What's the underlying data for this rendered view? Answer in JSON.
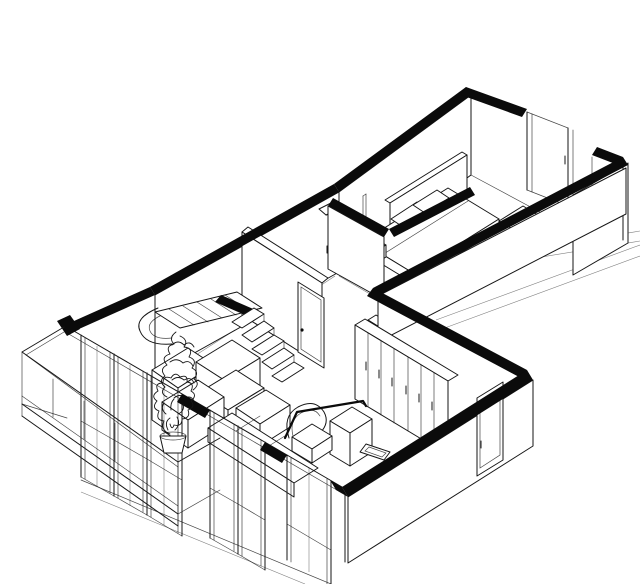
{
  "figure": {
    "kind": "isometric-cutaway-floor-plan",
    "description": "Black-and-white axonometric architectural drawing of an apartment, walls cut at mid height shown as solid black bands",
    "aria_label": "Isometric cutaway floor plan of an apartment"
  },
  "colors": {
    "background": "#ffffff",
    "line": "#161616",
    "cut_wall": "#0b0b0b"
  },
  "rooms": [
    {
      "name": "bedroom",
      "aria_label": "Bedroom with bed, headboard and sliding glass door"
    },
    {
      "name": "bathroom",
      "aria_label": "Bathroom with shower, glass screen and door"
    },
    {
      "name": "hallway",
      "aria_label": "Hallway with wardrobe cabinet"
    },
    {
      "name": "living-room",
      "aria_label": "Living room with stair seating boxes, sofa and armchair"
    },
    {
      "name": "kitchen",
      "aria_label": "Kitchen corner with counter, cabinet and arc lamp"
    },
    {
      "name": "balcony",
      "aria_label": "Balcony with glass railing and potted plant"
    }
  ],
  "furniture": [
    {
      "name": "bed",
      "aria_label": "Double bed with pillows"
    },
    {
      "name": "wardrobe",
      "aria_label": "Seven-door wardrobe"
    },
    {
      "name": "stairs",
      "aria_label": "Staircase with curved landing and plant"
    },
    {
      "name": "entrance-door",
      "aria_label": "Entrance door"
    },
    {
      "name": "facade-windows",
      "aria_label": "Floor to ceiling window wall"
    }
  ]
}
